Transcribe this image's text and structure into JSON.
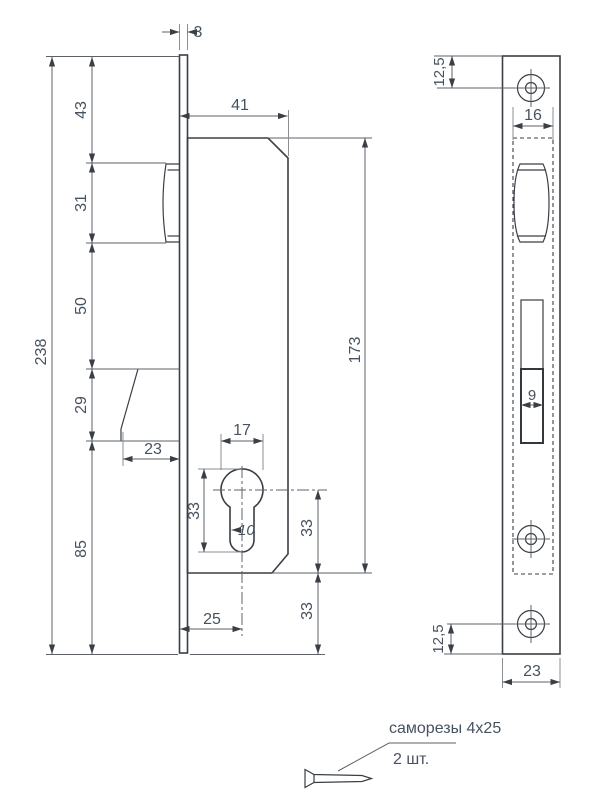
{
  "colors": {
    "object_line": "#3a3f45",
    "dimension_line": "#5d6268",
    "text": "#475260",
    "background": "#ffffff"
  },
  "left_view": {
    "description": "lock body side view",
    "dims": {
      "faceplate_thickness": "3",
      "total_height": "238",
      "top_to_latch": "43",
      "latch_height": "31",
      "latch_to_lever": "50",
      "lever_height": "29",
      "bottom_section": "85",
      "body_width": "41",
      "body_height": "173",
      "cylinder_width": "17",
      "cylinder_height": "33",
      "cylinder_slot_width": "10",
      "axis_to_body_bottom": "33",
      "body_to_plate_end": "33",
      "lever_depth": "23",
      "cylinder_axis_offset": "25"
    }
  },
  "right_view": {
    "description": "faceplate front view",
    "dims": {
      "screw_hole_top_offset": "12,5",
      "cutout_width": "16",
      "bolt_width": "9",
      "screw_hole_bottom_offset": "12,5",
      "plate_width": "23"
    }
  },
  "legend": {
    "screws_label": "саморезы 4x25",
    "quantity_label": "2 шт."
  }
}
